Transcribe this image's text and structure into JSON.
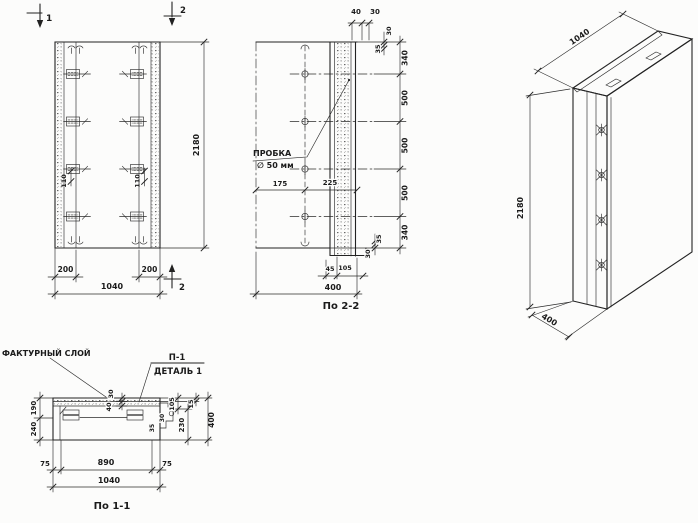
{
  "drawing": {
    "notes": {
      "plug_line1": "ПРОБКА",
      "plug_line2": "∅ 50 мм",
      "facing_layer": "ФАКТУРНЫЙ СЛОЙ",
      "detail_ref": "П-1",
      "detail_title": "ДЕТАЛЬ 1"
    },
    "captions": {
      "section2": "По 2-2",
      "section1": "По 1-1"
    },
    "marks": {
      "cut1": "1",
      "cut2": "2"
    },
    "front": {
      "height": "2180",
      "width": "1040",
      "edge_left": "200",
      "edge_right": "200",
      "pitch_left": "110",
      "pitch_right": "110"
    },
    "section2": {
      "top_w1": "40",
      "top_w2": "30",
      "off_top_a": "30",
      "off_top_b": "35",
      "seg_1": "340",
      "seg_2": "500",
      "seg_3": "500",
      "seg_4": "500",
      "seg_5": "340",
      "off_bot_a": "35",
      "off_bot_b": "30",
      "plug_left": "175",
      "plug_right": "225",
      "bot_a": "45",
      "bot_b": "105",
      "width": "400"
    },
    "axon": {
      "width": "1040",
      "height": "2180",
      "depth": "400"
    },
    "section1": {
      "left_top": "190",
      "left_bot": "240",
      "layer_a": "30",
      "layer_b": "40",
      "right_top": "105",
      "right_lip": "15",
      "right_mid": "230",
      "right_total": "400",
      "det_a": "30",
      "det_b": "35",
      "bot_left": "75",
      "bot_mid": "890",
      "bot_right": "75",
      "width": "1040"
    }
  }
}
